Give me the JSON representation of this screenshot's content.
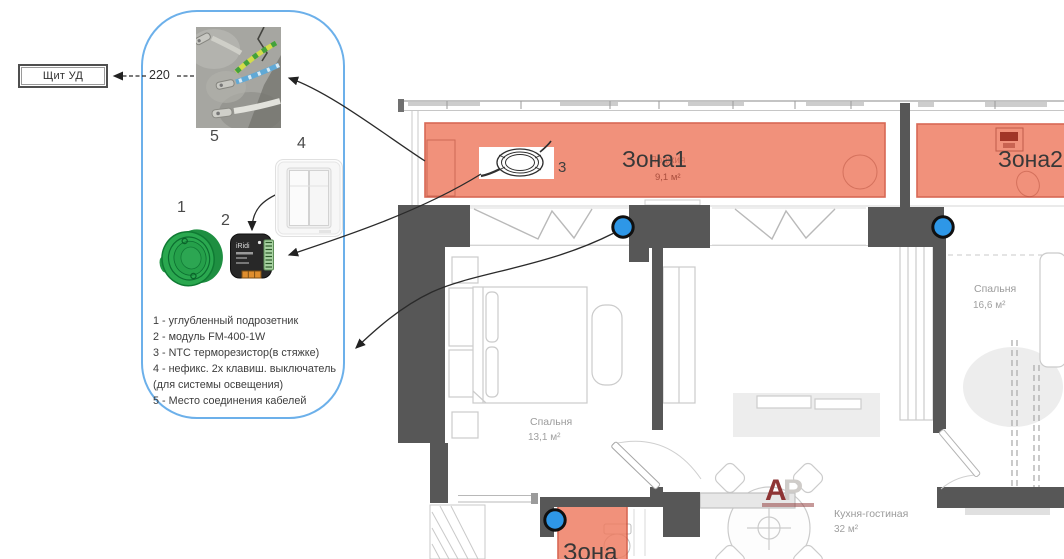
{
  "panel": {
    "board_label": "Щит УД",
    "voltage_label": "220",
    "module_brand": "iRidi",
    "labels": {
      "l1": "1",
      "l2": "2",
      "l3": "3",
      "l4": "4",
      "l5": "5"
    },
    "legend_lines": [
      "1 - углубленный подрозетник",
      "2 - модуль FM-400-1W",
      "3 - NTC терморезистор(в стяжке)",
      "4 - нефикс. 2х клавиш. выключатель",
      "(для системы освещения)",
      "5 - Место соединения кабелей"
    ]
  },
  "plan": {
    "zone1_label": "Зона1",
    "zone2_label": "Зона2",
    "zone3_label": "Зона",
    "loggia_name": "Лоджия",
    "loggia_area": "9,1 м²",
    "bedroom1_name": "Спальня",
    "bedroom1_area": "13,1 м²",
    "bedroom2_name": "Спальня",
    "bedroom2_area": "16,6 м²",
    "kitchen_name": "Кухня-гостиная",
    "kitchen_area": "32 м²",
    "watermark_a": "А",
    "watermark_r": "Р"
  },
  "colors": {
    "zone_fill": "#ef7a5f",
    "zone_border": "#cf4730",
    "panel_border": "#6cb0ea",
    "wall_dark": "#575757",
    "marker_blue": "#2e97e7"
  }
}
